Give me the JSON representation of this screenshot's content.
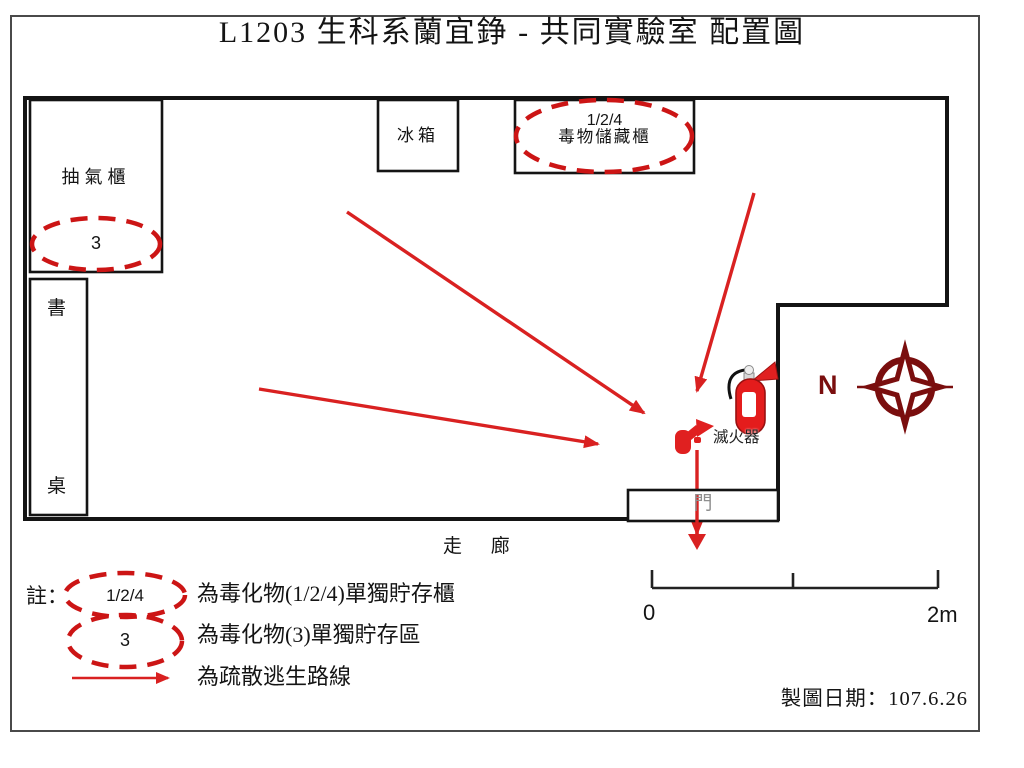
{
  "title": "L1203 生科系蘭宜錚 - 共同實驗室 配置圖",
  "room": {
    "fume_hood_label": "抽氣櫃",
    "fume_hood_zone_code": "3",
    "desk_label_char1": "書",
    "desk_label_char2": "桌",
    "fridge_label": "冰箱",
    "toxic_cabinet_code": "1/2/4",
    "toxic_cabinet_label": "毒物儲藏櫃",
    "extinguisher_label": "滅火器",
    "door_label": "門",
    "corridor_label": "走 廊",
    "compass_north_label": "N"
  },
  "scale_bar": {
    "start_label": "0",
    "end_label": "2m"
  },
  "legend": {
    "note_label": "註：",
    "items": [
      {
        "symbol": "dashed-ellipse",
        "symbol_text": "1/2/4",
        "label": "為毒化物(1/2/4)單獨貯存櫃"
      },
      {
        "symbol": "dashed-ellipse",
        "symbol_text": "3",
        "label": "為毒化物(3)單獨貯存區"
      },
      {
        "symbol": "red-arrow",
        "symbol_text": "",
        "label": "為疏散逃生路線"
      }
    ]
  },
  "footer": {
    "date_label": "製圖日期：107.6.26"
  },
  "colors": {
    "arrow_red": "#d92121",
    "dashed_red": "#cc1515",
    "compass_dark_red": "#7a0e0e",
    "wall_black": "#141414",
    "door_gray": "#8f8f8f"
  }
}
